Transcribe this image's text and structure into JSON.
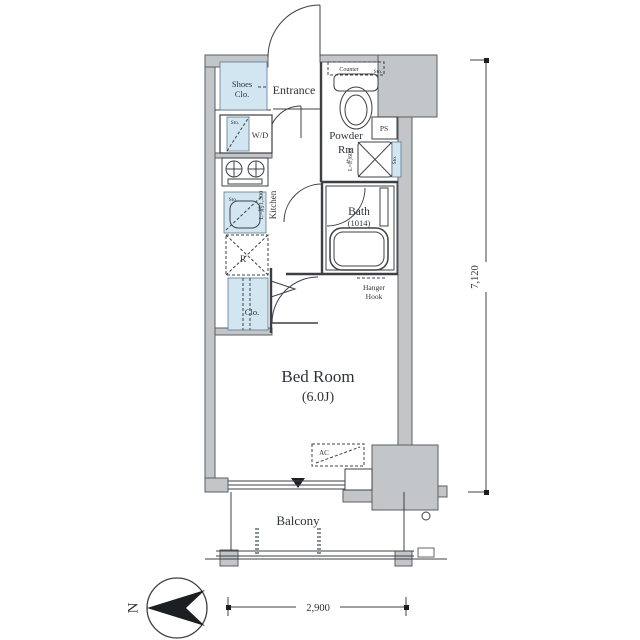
{
  "plan": {
    "rooms": {
      "entrance": "Entrance",
      "shoes_closet_line1": "Shoes",
      "shoes_closet_line2": "Clo.",
      "powder_line1": "Powder",
      "powder_line2": "Rm",
      "bath": "Bath",
      "bath_size": "(1014)",
      "kitchen": "Kitchen",
      "kitchen_length": "L=約1,300",
      "bedroom": "Bed Room",
      "bedroom_size": "(6.0J)",
      "balcony": "Balcony",
      "closet": "Clo.",
      "washer_dryer": "W/D",
      "refrigerator": "R",
      "pipe_space": "PS",
      "storage": "Sto.",
      "counter": "Counter",
      "hanger_line1": "Hanger",
      "hanger_line2": "Hook",
      "air_conditioner": "AC",
      "washbasin_length": "L=約600"
    },
    "dimensions": {
      "width": "2,900",
      "height": "7,120"
    },
    "compass": {
      "north": "N"
    },
    "colors": {
      "wall_fill": "#c2c6c9",
      "fixture_fill": "#d2e6f1",
      "line": "#3c4045"
    }
  }
}
